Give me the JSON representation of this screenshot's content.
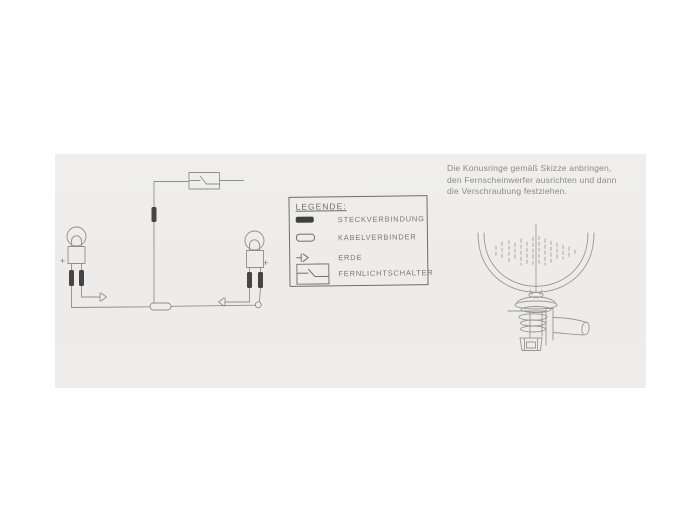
{
  "colors": {
    "page_background": "#ffffff",
    "scan_background": "#eeedeb",
    "sketch_line": "#8f8f8f",
    "text": "#8b8b8b",
    "plug_connector_fill": "#3f3f3f"
  },
  "instructions": {
    "lines": [
      "Die Konusringe gemäß Skizze anbringen,",
      "den Fernscheinwerfer ausrichten und dann",
      "die Verschraubung festziehen."
    ]
  },
  "legend": {
    "title": "LEGENDE:",
    "items": [
      {
        "icon": "plug-connector-icon",
        "label": "STECKVERBINDUNG"
      },
      {
        "icon": "cable-connector-icon",
        "label": "KABELVERBINDER"
      },
      {
        "icon": "ground-icon",
        "label": "ERDE"
      },
      {
        "icon": "high-beam-switch-icon",
        "label": "FERNLICHTSCHALTER"
      }
    ]
  },
  "circuit": {
    "left_lamp_polarity": "+",
    "right_lamp_polarity": "+"
  }
}
